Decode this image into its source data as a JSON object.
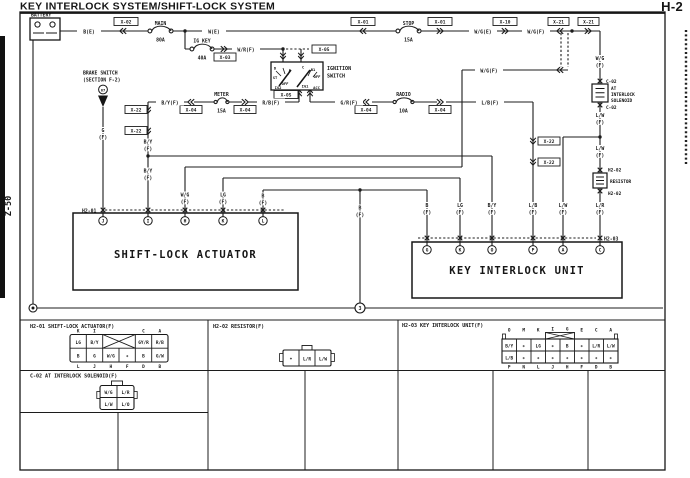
{
  "page": {
    "title": "KEY INTERLOCK SYSTEM/SHIFT-LOCK SYSTEM",
    "page_no": "H-2",
    "section_no": "Z-50"
  },
  "d": {
    "battery": "BATTERY",
    "b_e": "B(E)",
    "w_e": "W(E)",
    "wg_e": "W/G(E)",
    "wg_f": "W/G(F)",
    "wr_f": "W/R(F)",
    "by_f": "B/Y(F)",
    "rb_f": "R/B(F)",
    "gr_f": "G/R(F)",
    "lb_f": "L/B(F)",
    "x01": "X-01",
    "x02": "X-02",
    "x03": "X-03",
    "x04": "X-04",
    "x05": "X-05",
    "x10": "X-10",
    "x21": "X-21",
    "x22": "X-22",
    "main": "MAIN",
    "a80": "80A",
    "stop": "STOP",
    "a15": "15A",
    "igkey": "IG KEY",
    "a40": "40A",
    "meter": "METER",
    "radio": "RADIO",
    "a10": "10A",
    "ignition": "IGNITION",
    "switch": "SWITCH",
    "sw": {
      "d": "D",
      "st": "ST",
      "off": "OFF",
      "ig2": "IG2",
      "c": "C",
      "b1": "B1",
      "ig1": "IG1",
      "acc": "ACC"
    },
    "brake1": "BRAKE SWITCH",
    "brake2": "(SECTION F-2)",
    "brake_no": "67",
    "g": "G",
    "by": "B/Y",
    "wg": "W/G",
    "lg": "LG",
    "b": "B",
    "lb": "L/B",
    "lw": "L/W",
    "lr": "L/R",
    "f": "(F)",
    "c02": "C-02",
    "at": "AT",
    "interlock": "INTERLOCK",
    "solenoid": "SOLENOID",
    "h202": "H2-02",
    "resistor": "RESISTOR",
    "h201": "H2-01",
    "h203": "H2-03",
    "sla": "SHIFT-LOCK ACTUATOR",
    "kiu": "KEY INTERLOCK UNIT",
    "gnd": "3",
    "pins201": [
      "J",
      "I",
      "H",
      "K",
      "L"
    ],
    "pins203": [
      "G",
      "K",
      "O",
      "P",
      "A",
      "C"
    ]
  },
  "t201": {
    "title": "H2-01 SHIFT-LOCK ACTUATOR(F)",
    "lt": [
      "K",
      "I",
      "C",
      "A"
    ],
    "tc": [
      "LG",
      "B/Y",
      "GY/R",
      "R/B"
    ],
    "bc": [
      "B",
      "G",
      "W/G",
      "*",
      "B",
      "G/W"
    ],
    "bl": [
      "L",
      "J",
      "H",
      "F",
      "D",
      "B"
    ]
  },
  "tc02": {
    "title": "C-02 AT INTERLOCK SOLENOID(F)",
    "cells": [
      "W/G",
      "L/R",
      "L/W",
      "L/O"
    ]
  },
  "t202": {
    "title": "H2-02 RESISTOR(F)",
    "cells": [
      "*",
      "L/R",
      "L/W"
    ]
  },
  "t203": {
    "title": "H2-03 KEY INTERLOCK UNIT(F)",
    "lt": [
      "O",
      "M",
      "K",
      "I",
      "G",
      "E",
      "C",
      "A"
    ],
    "tc": [
      "B/Y",
      "*",
      "LG",
      "*",
      "B",
      "*",
      "L/R",
      "L/W"
    ],
    "bc": [
      "L/B",
      "*",
      "*",
      "*",
      "*",
      "*",
      "*",
      "*"
    ],
    "bl": [
      "P",
      "N",
      "L",
      "J",
      "H",
      "F",
      "D",
      "B"
    ]
  }
}
